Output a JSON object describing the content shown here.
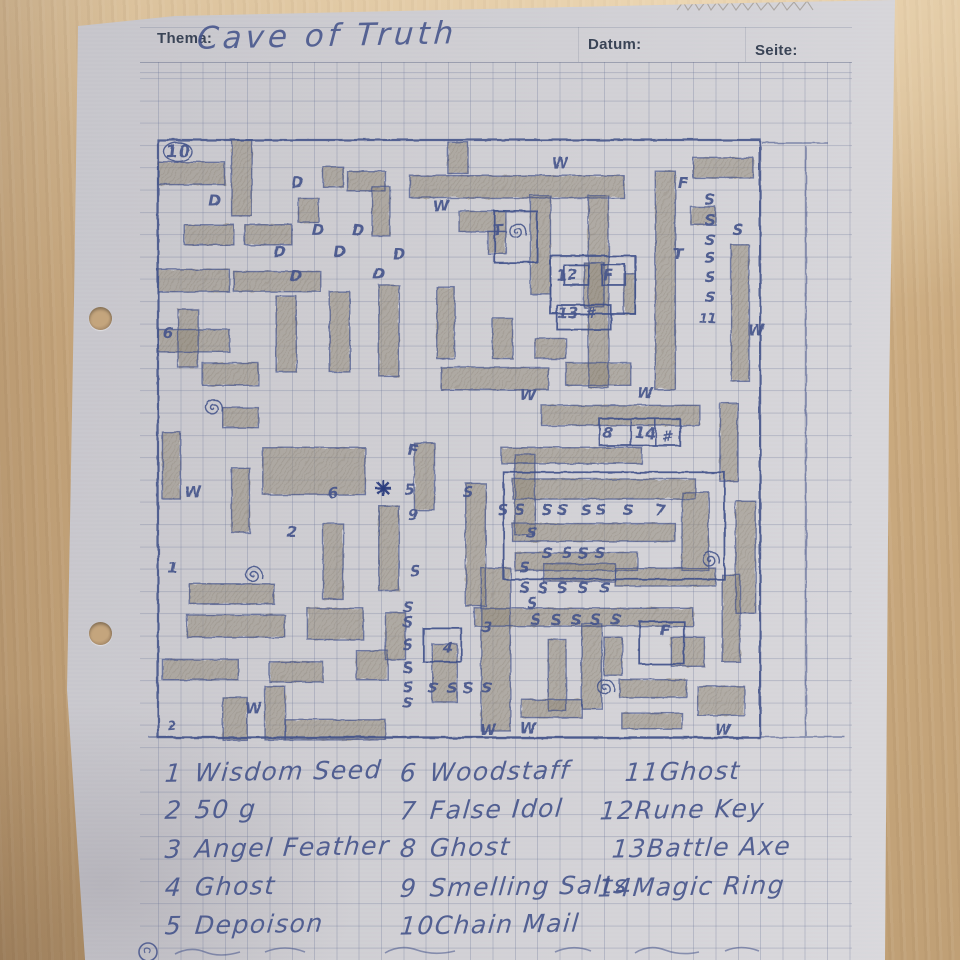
{
  "header": {
    "thema_label": "Thema:",
    "title": "Cave of Truth",
    "datum_label": "Datum:",
    "seite_label": "Seite:"
  },
  "colors": {
    "pen": "#45548b",
    "pen_dark": "#2c3d7e",
    "pencil": "#968e7f",
    "pencil_line": "#7a7263",
    "paper": "#cecdd2",
    "wood": "#cbab80"
  },
  "map": {
    "cell": 22.3,
    "origin_page": {
      "x": 158,
      "y": 140
    },
    "cols": 27,
    "rows": 26.8,
    "shaded": [
      [
        0,
        1,
        3,
        1
      ],
      [
        3.3,
        0,
        0.9,
        3.4
      ],
      [
        7.4,
        1.2,
        0.9,
        0.9
      ],
      [
        8.5,
        1.4,
        1.7,
        0.9
      ],
      [
        9.6,
        2.1,
        0.8,
        2.2
      ],
      [
        13,
        0.1,
        0.9,
        1.4
      ],
      [
        11.3,
        1.6,
        9.6,
        1
      ],
      [
        1.2,
        3.8,
        2.2,
        0.9
      ],
      [
        3.9,
        3.8,
        2.1,
        0.9
      ],
      [
        0,
        5.8,
        3.2,
        1
      ],
      [
        3.4,
        5.9,
        3.9,
        0.9
      ],
      [
        13.5,
        3.2,
        2.1,
        0.9
      ],
      [
        14.8,
        4.1,
        0.8,
        1
      ],
      [
        16.7,
        2.5,
        0.9,
        4.4
      ],
      [
        19.3,
        2.5,
        0.9,
        8.6
      ],
      [
        22.3,
        1.4,
        0.9,
        9.8
      ],
      [
        24,
        0.8,
        2.7,
        0.9
      ],
      [
        25.7,
        4.7,
        0.8,
        6.1
      ],
      [
        23.9,
        3,
        1.1,
        0.8
      ],
      [
        0.9,
        7.6,
        0.9,
        2.6
      ],
      [
        0,
        8.5,
        3.2,
        1
      ],
      [
        2,
        10,
        2.5,
        1
      ],
      [
        5.3,
        7,
        0.9,
        3.4
      ],
      [
        7.7,
        6.8,
        0.9,
        3.6
      ],
      [
        9.9,
        6.5,
        0.9,
        4.1
      ],
      [
        12.5,
        6.6,
        0.8,
        3.2
      ],
      [
        15,
        8,
        0.9,
        1.8
      ],
      [
        19.1,
        5.5,
        0.9,
        2
      ],
      [
        20.9,
        6,
        0.5,
        1.8
      ],
      [
        18.3,
        10,
        2.9,
        1
      ],
      [
        12.7,
        10.2,
        4.8,
        1
      ],
      [
        16.9,
        8.9,
        1.4,
        0.9
      ],
      [
        17.2,
        11.9,
        7.1,
        0.9
      ],
      [
        15.4,
        13.8,
        6.3,
        0.7
      ],
      [
        25.2,
        11.8,
        0.8,
        3.5
      ],
      [
        15.9,
        15.2,
        8.2,
        0.9
      ],
      [
        15.9,
        17.2,
        7.3,
        0.8
      ],
      [
        16,
        18.5,
        5.5,
        0.8
      ],
      [
        23.5,
        15.8,
        1.2,
        3.5
      ],
      [
        25.9,
        16.2,
        0.9,
        5
      ],
      [
        0.2,
        13.1,
        0.8,
        3
      ],
      [
        3.3,
        14.7,
        0.8,
        2.9
      ],
      [
        4.7,
        13.8,
        4.6,
        2.1
      ],
      [
        1.4,
        19.9,
        3.8,
        0.9
      ],
      [
        7.4,
        17.2,
        0.9,
        3.4
      ],
      [
        9.9,
        16.4,
        0.9,
        3.8
      ],
      [
        11.5,
        13.6,
        0.9,
        3
      ],
      [
        13.8,
        15.4,
        0.9,
        5.5
      ],
      [
        16,
        14.1,
        0.9,
        3.6
      ],
      [
        1.3,
        21.3,
        4.4,
        1
      ],
      [
        6.7,
        21,
        2.5,
        1.4
      ],
      [
        0.2,
        23.3,
        3.4,
        0.9
      ],
      [
        5,
        23.4,
        2.4,
        0.9
      ],
      [
        8.9,
        22.9,
        1.4,
        1.3
      ],
      [
        2.9,
        25,
        1.1,
        1.9
      ],
      [
        4.8,
        24.5,
        0.9,
        2.4
      ],
      [
        5.7,
        26,
        4.5,
        0.9
      ],
      [
        10.2,
        21.2,
        0.9,
        2.1
      ],
      [
        14.5,
        19.2,
        1.3,
        7.3
      ],
      [
        17.3,
        19,
        3.2,
        0.8
      ],
      [
        20.5,
        19.2,
        4.5,
        0.8
      ],
      [
        14.2,
        21,
        9.8,
        0.8
      ],
      [
        19,
        21.7,
        0.9,
        3.8
      ],
      [
        17.5,
        22.4,
        0.8,
        3.2
      ],
      [
        23,
        22.3,
        1.5,
        1.3
      ],
      [
        25.3,
        19.5,
        0.8,
        3.9
      ],
      [
        20.7,
        24.2,
        3,
        0.8
      ],
      [
        24.2,
        24.5,
        2.1,
        1.3
      ],
      [
        16.3,
        25.1,
        2.7,
        0.8
      ],
      [
        20.8,
        25.7,
        2.7,
        0.7
      ],
      [
        12.3,
        22.6,
        1.1,
        2.6
      ],
      [
        20,
        22.3,
        0.8,
        1.7
      ],
      [
        6.3,
        2.6,
        0.9,
        1.1
      ],
      [
        2.9,
        12,
        1.6,
        0.9
      ]
    ],
    "rooms": [
      [
        17.6,
        5.2,
        3.8,
        2.6
      ],
      [
        17.9,
        7.4,
        2.4,
        1.1
      ],
      [
        19.8,
        12.5,
        3.6,
        1.2
      ],
      [
        15.5,
        14.9,
        9.9,
        4.8
      ],
      [
        21.6,
        21.6,
        2,
        1.9
      ],
      [
        11.9,
        21.9,
        1.7,
        1.5
      ],
      [
        15.1,
        3.2,
        1.9,
        2.3
      ],
      [
        18.2,
        5.6,
        1.1,
        0.9
      ],
      [
        19.9,
        5.6,
        1.05,
        0.9
      ]
    ],
    "divider_lines_cells": [
      [
        21.2,
        12.5,
        21.2,
        13.7
      ],
      [
        22.3,
        12.5,
        22.3,
        13.7
      ]
    ],
    "extra_lines_page": [
      [
        140,
        737,
        845,
        737
      ],
      [
        806,
        146,
        806,
        736
      ],
      [
        762,
        143,
        828,
        143
      ]
    ],
    "labels": [
      [
        "10",
        178,
        152,
        17,
        1
      ],
      [
        "D",
        298,
        183
      ],
      [
        "D",
        215,
        201
      ],
      [
        "D",
        318,
        230
      ],
      [
        "D",
        358,
        230
      ],
      [
        "D",
        280,
        252
      ],
      [
        "D",
        340,
        252
      ],
      [
        "D",
        399,
        254
      ],
      [
        "D",
        379,
        274
      ],
      [
        "D",
        296,
        276
      ],
      [
        "W",
        441,
        206
      ],
      [
        "W",
        560,
        163
      ],
      [
        "W",
        756,
        330
      ],
      [
        "W",
        528,
        395
      ],
      [
        "W",
        645,
        393
      ],
      [
        "W",
        193,
        492
      ],
      [
        "W",
        253,
        708
      ],
      [
        "W",
        488,
        730
      ],
      [
        "W",
        528,
        728
      ],
      [
        "W",
        723,
        730
      ],
      [
        "T",
        498,
        230
      ],
      [
        "T",
        678,
        254
      ],
      [
        "F",
        683,
        183
      ],
      [
        "F",
        608,
        275
      ],
      [
        "F",
        413,
        450
      ],
      [
        "F",
        665,
        630
      ],
      [
        "S",
        710,
        200
      ],
      [
        "S",
        710,
        220
      ],
      [
        "S",
        738,
        230
      ],
      [
        "S",
        710,
        240
      ],
      [
        "S",
        710,
        258
      ],
      [
        "S",
        710,
        277
      ],
      [
        "S",
        710,
        297
      ],
      [
        "11",
        708,
        318,
        13
      ],
      [
        "6",
        168,
        333
      ],
      [
        "12",
        567,
        275
      ],
      [
        "13",
        568,
        313
      ],
      [
        "#",
        590,
        313
      ],
      [
        "8",
        608,
        433
      ],
      [
        "14",
        645,
        433
      ],
      [
        "#",
        667,
        437
      ],
      [
        "S",
        503,
        510
      ],
      [
        "S",
        520,
        510
      ],
      [
        "S",
        547,
        510
      ],
      [
        "S",
        563,
        510
      ],
      [
        "S",
        586,
        510
      ],
      [
        "S",
        601,
        510
      ],
      [
        "S",
        628,
        510
      ],
      [
        "7",
        660,
        510
      ],
      [
        "S",
        532,
        533
      ],
      [
        "S",
        532,
        603
      ],
      [
        "S",
        547,
        553
      ],
      [
        "S",
        567,
        553
      ],
      [
        "S",
        583,
        553
      ],
      [
        "S",
        600,
        553
      ],
      [
        "S",
        536,
        620
      ],
      [
        "S",
        556,
        620
      ],
      [
        "S",
        576,
        620
      ],
      [
        "S",
        596,
        620
      ],
      [
        "S",
        616,
        620
      ],
      [
        "S",
        415,
        571
      ],
      [
        "S",
        468,
        492
      ],
      [
        "S",
        525,
        568
      ],
      [
        "S",
        525,
        588
      ],
      [
        "S",
        543,
        588
      ],
      [
        "S",
        562,
        588
      ],
      [
        "S",
        583,
        588
      ],
      [
        "S",
        605,
        588
      ],
      [
        "S",
        408,
        607
      ],
      [
        "S",
        408,
        622
      ],
      [
        "S",
        408,
        645
      ],
      [
        "S",
        408,
        668
      ],
      [
        "S",
        408,
        687
      ],
      [
        "S",
        408,
        703
      ],
      [
        "S",
        433,
        688
      ],
      [
        "S",
        452,
        688
      ],
      [
        "S",
        468,
        688
      ],
      [
        "S",
        487,
        688
      ],
      [
        "5",
        410,
        490
      ],
      [
        "9",
        413,
        515
      ],
      [
        "6",
        333,
        493
      ],
      [
        "2",
        292,
        532
      ],
      [
        "1",
        173,
        568
      ],
      [
        "3",
        487,
        627
      ],
      [
        "4",
        448,
        648
      ],
      [
        "2",
        172,
        725,
        12
      ]
    ],
    "spirals": [
      [
        517,
        232
      ],
      [
        213,
        408
      ],
      [
        253,
        575
      ],
      [
        710,
        560
      ],
      [
        605,
        688
      ]
    ],
    "asterisk": [
      383,
      488
    ]
  },
  "legend": {
    "items": [
      {
        "n": "1",
        "label": "Wisdom Seed",
        "x": 165,
        "y": 757
      },
      {
        "n": "2",
        "label": "50 g",
        "x": 165,
        "y": 795
      },
      {
        "n": "3",
        "label": "Angel Feather",
        "x": 165,
        "y": 833
      },
      {
        "n": "4",
        "label": "Ghost",
        "x": 165,
        "y": 872
      },
      {
        "n": "5",
        "label": "Depoison",
        "x": 165,
        "y": 910
      },
      {
        "n": "6",
        "label": "Woodstaff",
        "x": 400,
        "y": 757
      },
      {
        "n": "7",
        "label": "False Idol",
        "x": 400,
        "y": 795
      },
      {
        "n": "8",
        "label": "Ghost",
        "x": 400,
        "y": 833
      },
      {
        "n": "9",
        "label": "Smelling Salts",
        "x": 400,
        "y": 872
      },
      {
        "n": "10",
        "label": "Chain Mail",
        "x": 400,
        "y": 910
      },
      {
        "n": "11",
        "label": "Ghost",
        "x": 625,
        "y": 757
      },
      {
        "n": "12",
        "label": "Rune Key",
        "x": 600,
        "y": 795
      },
      {
        "n": "13",
        "label": "Battle Axe",
        "x": 612,
        "y": 833
      },
      {
        "n": "14",
        "label": "Magic Ring",
        "x": 598,
        "y": 872
      }
    ]
  }
}
